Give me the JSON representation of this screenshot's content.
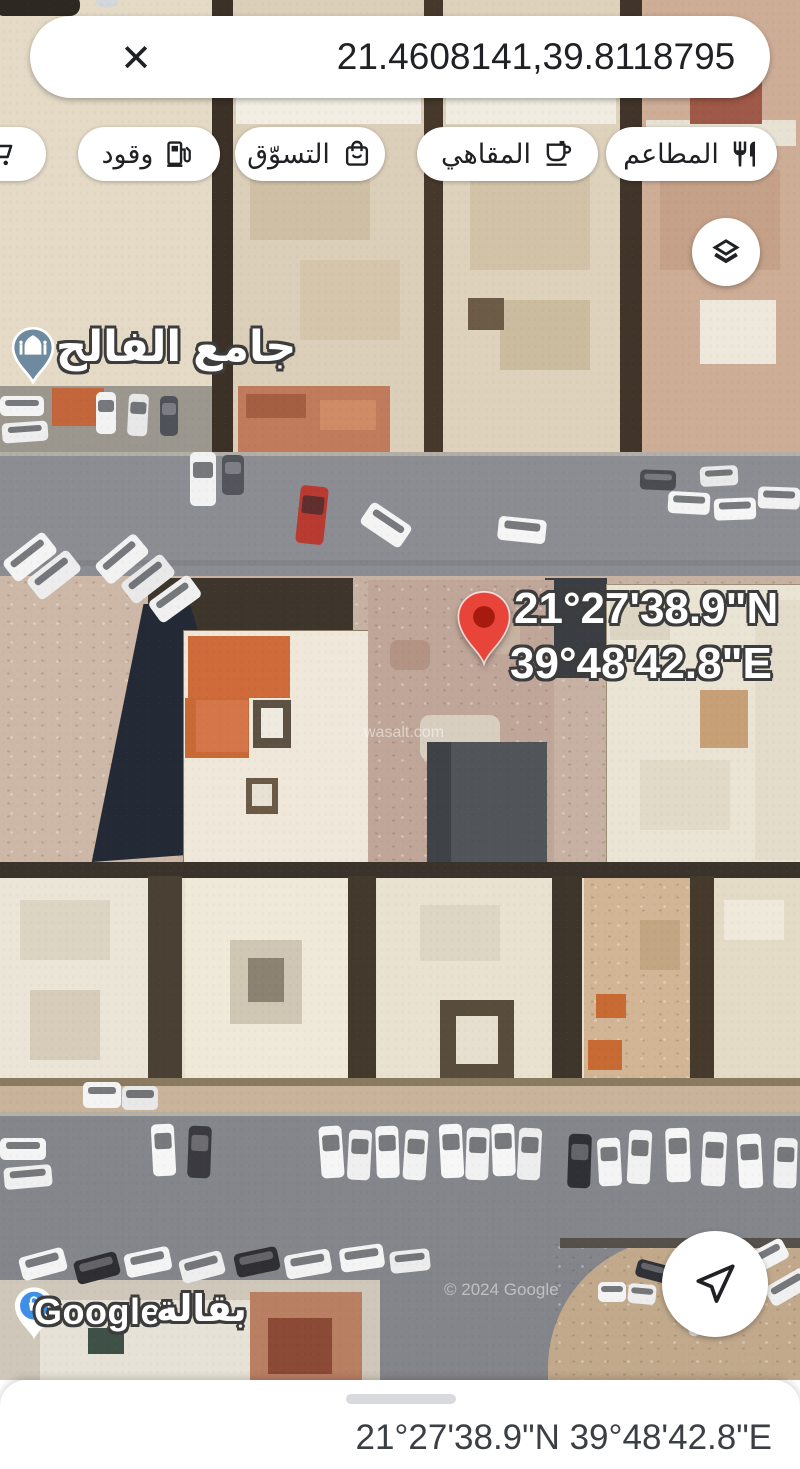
{
  "search_bar": {
    "query": "21.4608141,39.8118795",
    "close_icon": "✕"
  },
  "chips": {
    "items": [
      {
        "id": "stores",
        "icon": "shopping-cart-icon"
      },
      {
        "id": "fuel",
        "icon": "gas-station-icon",
        "label": "وقود"
      },
      {
        "id": "shopping",
        "icon": "shopping-bag-icon",
        "label": "التسوّق"
      },
      {
        "id": "cafes",
        "icon": "coffee-cup-icon",
        "label": "المقاهي"
      },
      {
        "id": "restaurants",
        "icon": "restaurant-icon",
        "label": "المطاعم"
      }
    ]
  },
  "map": {
    "type": "satellite",
    "poi": {
      "mosque": {
        "label": "جامع الفالح",
        "icon": "mosque-icon",
        "color": "#6d8a9e"
      },
      "grocery": {
        "label": "بقالة",
        "icon": "grocery-icon",
        "color": "#3f8fe9"
      }
    },
    "pin": {
      "lat": "21°27'38.9\"N",
      "lng": "39°48'42.8\"E",
      "color": "#e8443a"
    },
    "watermarks": {
      "google": "Google",
      "copyright": "© 2024 Google",
      "wasalt": "wasalt.com"
    },
    "controls": {
      "layers_icon": "layers-icon",
      "navigate_icon": "navigation-arrow-icon"
    }
  },
  "bottom_sheet": {
    "coordinates": "21°27'38.9\"N 39°48'42.8\"E"
  }
}
